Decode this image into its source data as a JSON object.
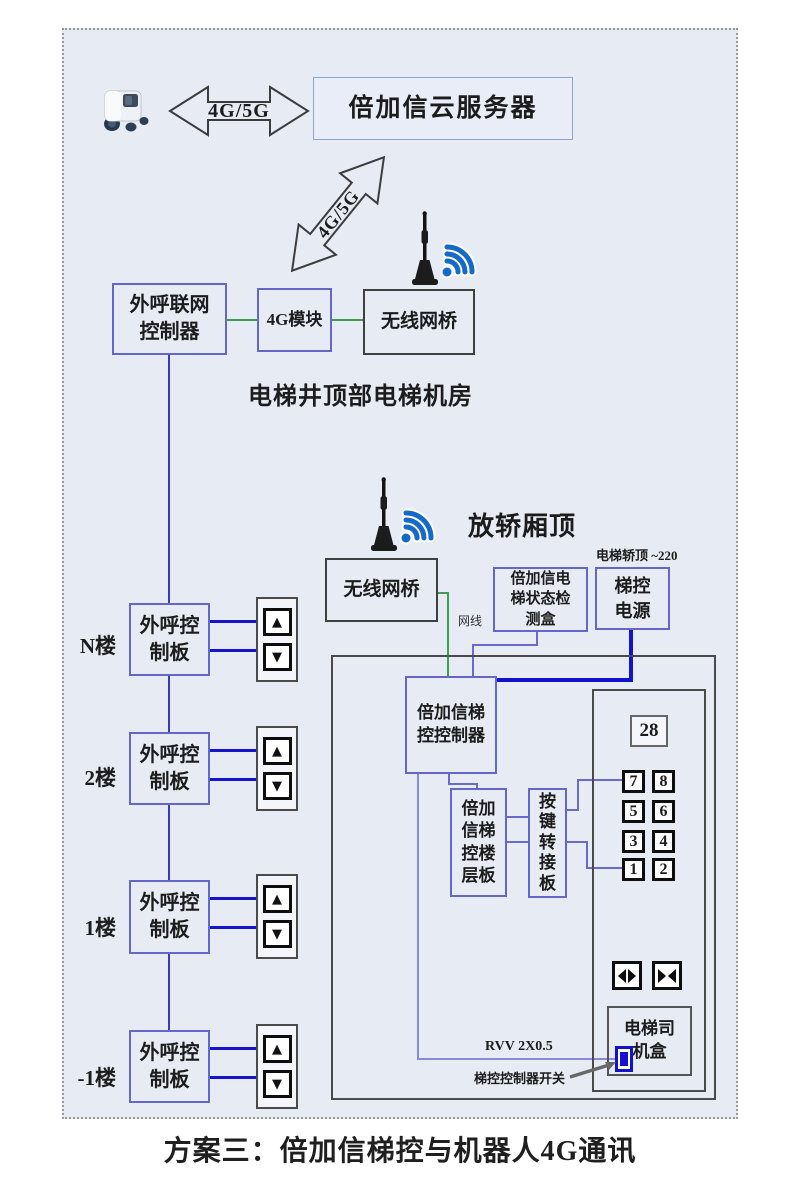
{
  "page": {
    "title": "方案三：倍加信梯控与机器人4G通讯"
  },
  "top": {
    "robot_icon": "delivery-robot",
    "link_label": "4G/5G",
    "cloud_server_label": "倍加信云服务器",
    "diagonal_link_label": "4G/5G"
  },
  "machine_room": {
    "caption": "电梯井顶部电梯机房",
    "antenna_icon": "wifi-antenna",
    "outcall_net_controller": [
      "外呼联网",
      "控制器"
    ],
    "module_4g": "4G模块",
    "wireless_bridge": "无线网桥"
  },
  "car_top": {
    "caption": "放轿厢顶",
    "antenna_icon": "wifi-antenna",
    "wireless_bridge": "无线网桥",
    "net_cable_label": "网线",
    "status_detect_box": [
      "倍加信电",
      "梯状态检",
      "测盒"
    ],
    "power_note": "电梯轿顶 ~220",
    "power_box": [
      "梯控",
      "电源"
    ]
  },
  "floors": {
    "board_label": [
      "外呼控",
      "制板"
    ],
    "up_icon": "▲",
    "down_icon": "▼",
    "rows": [
      {
        "label": "N楼"
      },
      {
        "label": "2楼"
      },
      {
        "label": "1楼"
      },
      {
        "label": "-1楼"
      }
    ]
  },
  "car_panel": {
    "controller": [
      "倍加信梯",
      "控控制器"
    ],
    "floor_board": [
      "倍加",
      "信梯",
      "控楼",
      "层板"
    ],
    "key_adapter": [
      "按",
      "键",
      "转",
      "接",
      "板"
    ],
    "floor_display": "28",
    "key_rows": [
      [
        "7",
        "8"
      ],
      [
        "5",
        "6"
      ],
      [
        "3",
        "4"
      ],
      [
        "1",
        "2"
      ]
    ],
    "driver_box": [
      "电梯司",
      "机盒"
    ],
    "rvv_label": "RVV 2X0.5",
    "switch_label": "梯控控制器开关"
  },
  "colors": {
    "page_bg": "#e7ebf4",
    "box_border_blue": "#6467c8",
    "box_border_dark": "#3f3f3f",
    "line_green": "#3f9e53",
    "line_blue": "#1414cc",
    "line_purple": "#6a6ace",
    "power_line_blue": "#1212cc",
    "wifi_blue": "#1569c8"
  }
}
